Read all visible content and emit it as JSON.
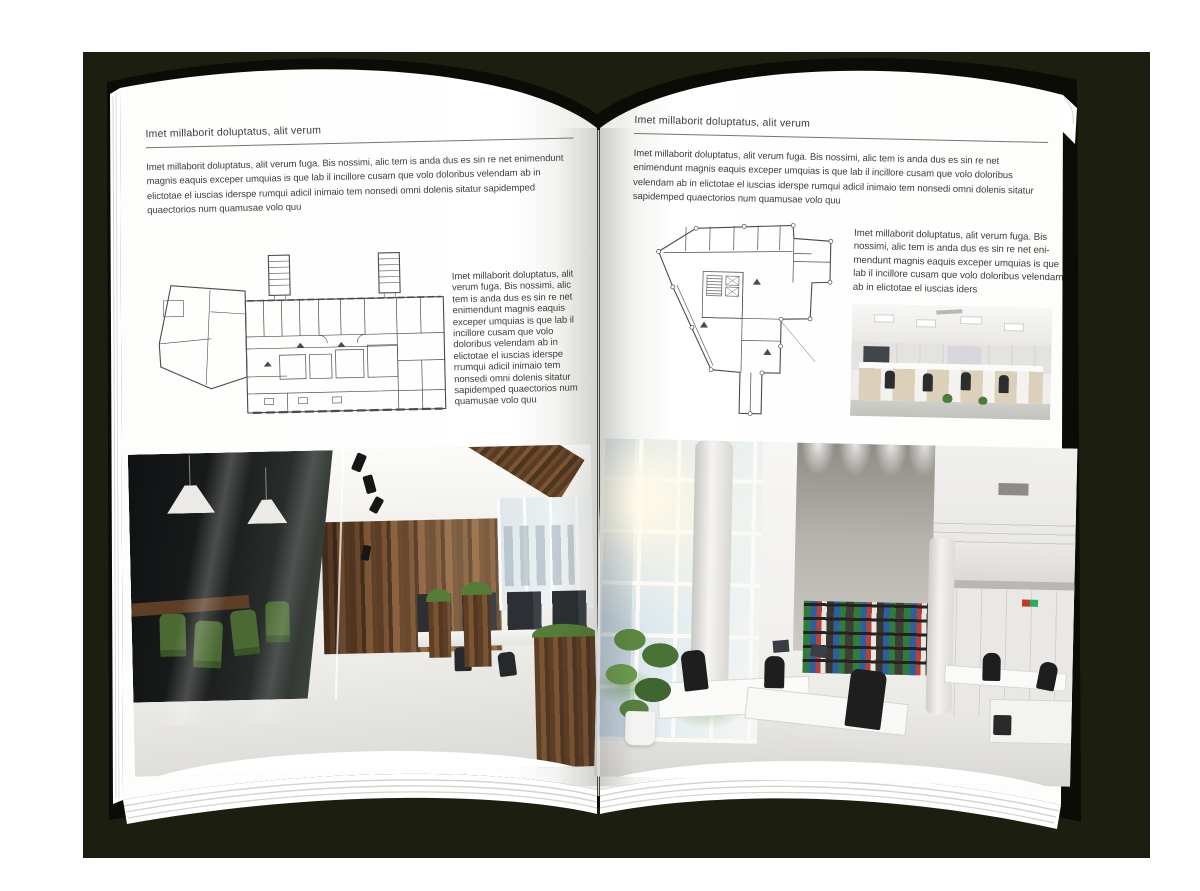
{
  "colors": {
    "backdrop": "#1c1f10",
    "cover": "#0b0c06",
    "page": "#ffffff",
    "plan_line": "#4b4b4b",
    "rule": "#757575",
    "body_text": "#3d3d3d",
    "wood": "#6e4b2e",
    "chair_green": "#4b6a33",
    "binder_green": "#2e7d3f",
    "binder_blue": "#2d5fa0",
    "binder_red": "#b5423a"
  },
  "left_page": {
    "header": "Imet millaborit doluptatus, alit verum",
    "intro": "Imet millaborit doluptatus, alit verum fuga. Bis nossimi, alic tem is anda dus es sin re net enimendunt magnis eaquis exceper umquias is que lab il incillore cusam que volo doloribus velendam ab in elictotae el iuscias iderspe rumqui adicil inimaio tem nonsedi omni dolenis sitatur sapidemped quaectorios num quamusae volo quu",
    "side_text": "Imet millaborit doluptatus, alit verum fuga. Bis nossimi, alic tem is anda dus es sin re net enimendunt magnis eaquis exceper umquias is que lab il incillore cusam que volo doloribus velendam ab in elictotae el iuscias iderspe rrumqui adicil inimaio tem nonsedi omni dolenis sitatur sapidemped quaectorios num quamusae volo quu"
  },
  "right_page": {
    "header": "Imet millaborit doluptatus, alit verum",
    "intro": "Imet millaborit doluptatus, alit verum fuga. Bis nossimi, alic tem is anda dus es sin re net enimendunt magnis eaquis exceper umquias is que lab il incillore cusam que volo doloribus velendam ab in elictotae el iuscias iderspe rumqui adicil inimaio tem nonsedi omni dolenis sitatur sapidemped quaectorios num quamusae volo quu",
    "side_text": "Imet millaborit doluptatus, alit verum fuga. Bis nossimi, alic tem is anda dus es sin re net eni-mendunt magnis eaquis exceper umquias is que lab il incillore cusam que volo doloribus velendam ab in elictotae el iuscias iders"
  }
}
